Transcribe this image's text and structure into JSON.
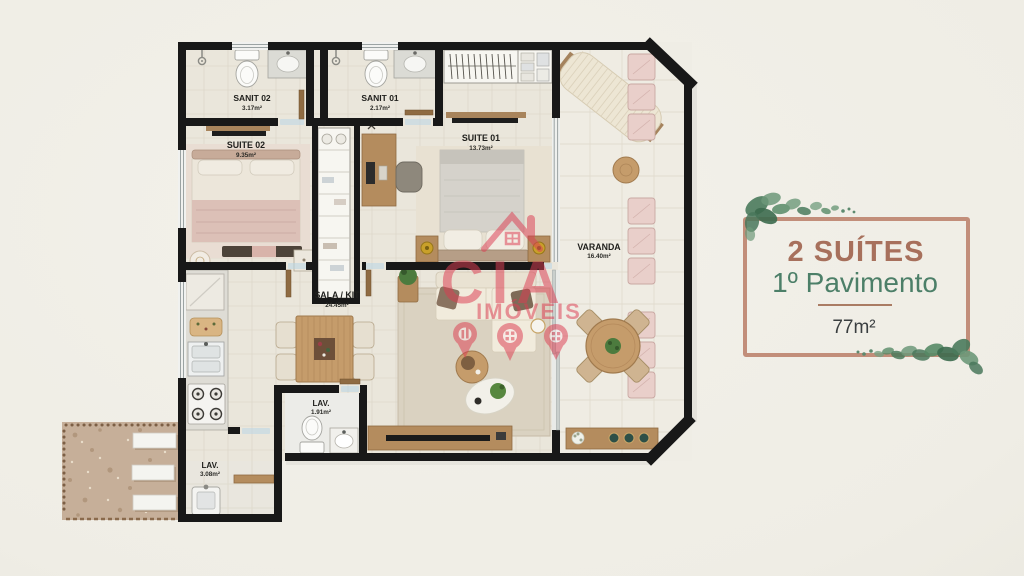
{
  "scene": {
    "description": "apartment floor plan marketing image"
  },
  "floorplan": {
    "rooms": {
      "sanit02": {
        "label": "SANIT 02",
        "area": "3.17m²"
      },
      "sanit01": {
        "label": "SANIT 01",
        "area": "2.17m²"
      },
      "suite02": {
        "label": "SUITE 02",
        "area": "9.35m²"
      },
      "suite01": {
        "label": "SUITE 01",
        "area": "13.73m²"
      },
      "varanda": {
        "label": "VARANDA",
        "area": "16.40m²"
      },
      "sala_kit": {
        "label": "SALA / KIT",
        "area": "24.45m²"
      },
      "lav_small": {
        "label": "LAV.",
        "area": "1.91m²"
      },
      "lav_service": {
        "label": "LAV.",
        "area": "3.08m²"
      }
    }
  },
  "watermark": {
    "brand": "CIA",
    "word": "IMÓVEIS",
    "color": "#dc3d52"
  },
  "info_panel": {
    "title": "2 SUÍTES",
    "subtitle": "1º Pavimento",
    "area": "77m²",
    "title_color": "#a7705c",
    "subtitle_color": "#4c7f68",
    "divider_color": "#a06b52",
    "area_color": "#3a3e40",
    "frame_color": "#c28e7a"
  },
  "colors": {
    "background": "#efede5",
    "wall": "#181818",
    "floor_tile": "#eae6db",
    "wood_accent": "#b48c5e",
    "cushion_pink": "#e9cfca",
    "leaf_green": "#4a7a5c"
  }
}
